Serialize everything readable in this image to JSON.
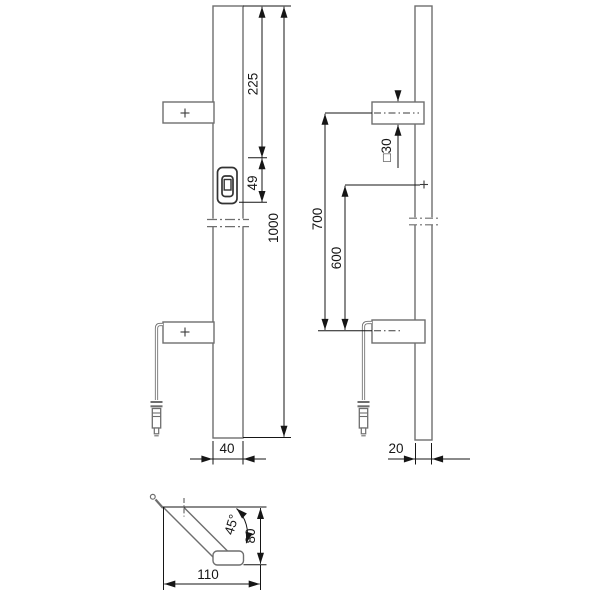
{
  "drawing": {
    "description": "technical-drawing-door-pull-handle",
    "colors": {
      "outline": "#6e6e6e",
      "dimension": "#1a1a1a",
      "lock_detail": "#333333",
      "background": "#ffffff"
    },
    "symbols": {
      "center_mark": "+"
    }
  },
  "dimensions": {
    "front_view": {
      "overall_length": "1000",
      "top_to_lock": "225",
      "lock_section": "49",
      "profile_width": "40"
    },
    "side_view": {
      "upper_fixing_distance": "700",
      "lower_fixing_distance": "600",
      "bracket_profile": "□30",
      "profile_depth": "20"
    },
    "plan_detail": {
      "overall_projection": "110",
      "offset_depth": "80",
      "mounting_angle": "45°"
    }
  }
}
